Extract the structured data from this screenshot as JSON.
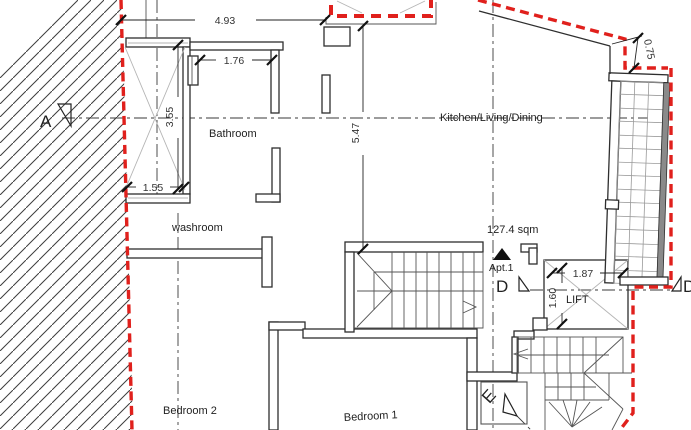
{
  "drawing": {
    "type": "architectural floor plan",
    "apartment": {
      "label": "Apt.1",
      "area": "127.4 sqm"
    },
    "rooms": {
      "kitchen_living_dining": "Kitchen/Living/Dining",
      "bathroom": "Bathroom",
      "washroom": "washroom",
      "bedroom_1": "Bedroom 1",
      "bedroom_2": "Bedroom 2",
      "lift": "LIFT"
    },
    "section_markers": {
      "a": "A",
      "d": "D",
      "d_right": "D",
      "e": "E"
    },
    "dimensions_m": {
      "top_width": "4.93",
      "bathroom_width": "1.76",
      "shaft_height": "3.55",
      "shaft_width": "1.55",
      "living_depth": "5.47",
      "terrace_offset": "0.75",
      "lift_width": "1.87",
      "lift_depth": "1.60"
    },
    "colors": {
      "boundary_dashed": "#e0201c",
      "walls": "#2e2e2e",
      "centerlines": "#3a3a3a",
      "grid_thin": "#9a9a9a",
      "background": "#ffffff"
    }
  }
}
